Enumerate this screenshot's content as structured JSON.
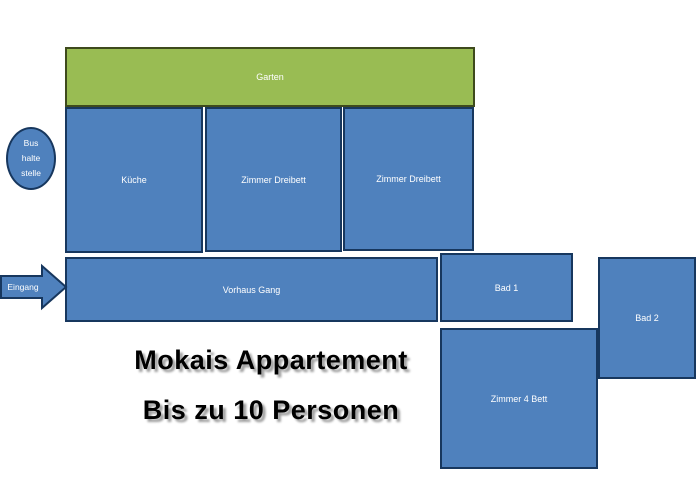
{
  "colors": {
    "room_fill": "#4F81BD",
    "room_border": "#17375E",
    "garden_fill": "#99BC53",
    "garden_border": "#3E4A1D",
    "label_text": "#FFFFFF",
    "title_text": "#000000",
    "title_shadow": "#A0A0A0",
    "background": "#FFFFFF"
  },
  "rooms": {
    "garten": {
      "label": "Garten"
    },
    "kueche": {
      "label": "Küche"
    },
    "zimmer_dreibett_1": {
      "label": "Zimmer Dreibett"
    },
    "zimmer_dreibett_2": {
      "label": "Zimmer Dreibett"
    },
    "vorhaus_gang": {
      "label": "Vorhaus Gang"
    },
    "bad_1": {
      "label": "Bad 1"
    },
    "bad_2": {
      "label": "Bad 2"
    },
    "zimmer_4_bett": {
      "label": "Zimmer 4 Bett"
    }
  },
  "annotations": {
    "bus_stop": {
      "lines": [
        "Bus",
        "halte",
        "stelle"
      ]
    },
    "entrance": {
      "label": "Eingang"
    }
  },
  "title": {
    "line1": "Mokais Appartement",
    "line2": "Bis zu 10 Personen"
  }
}
